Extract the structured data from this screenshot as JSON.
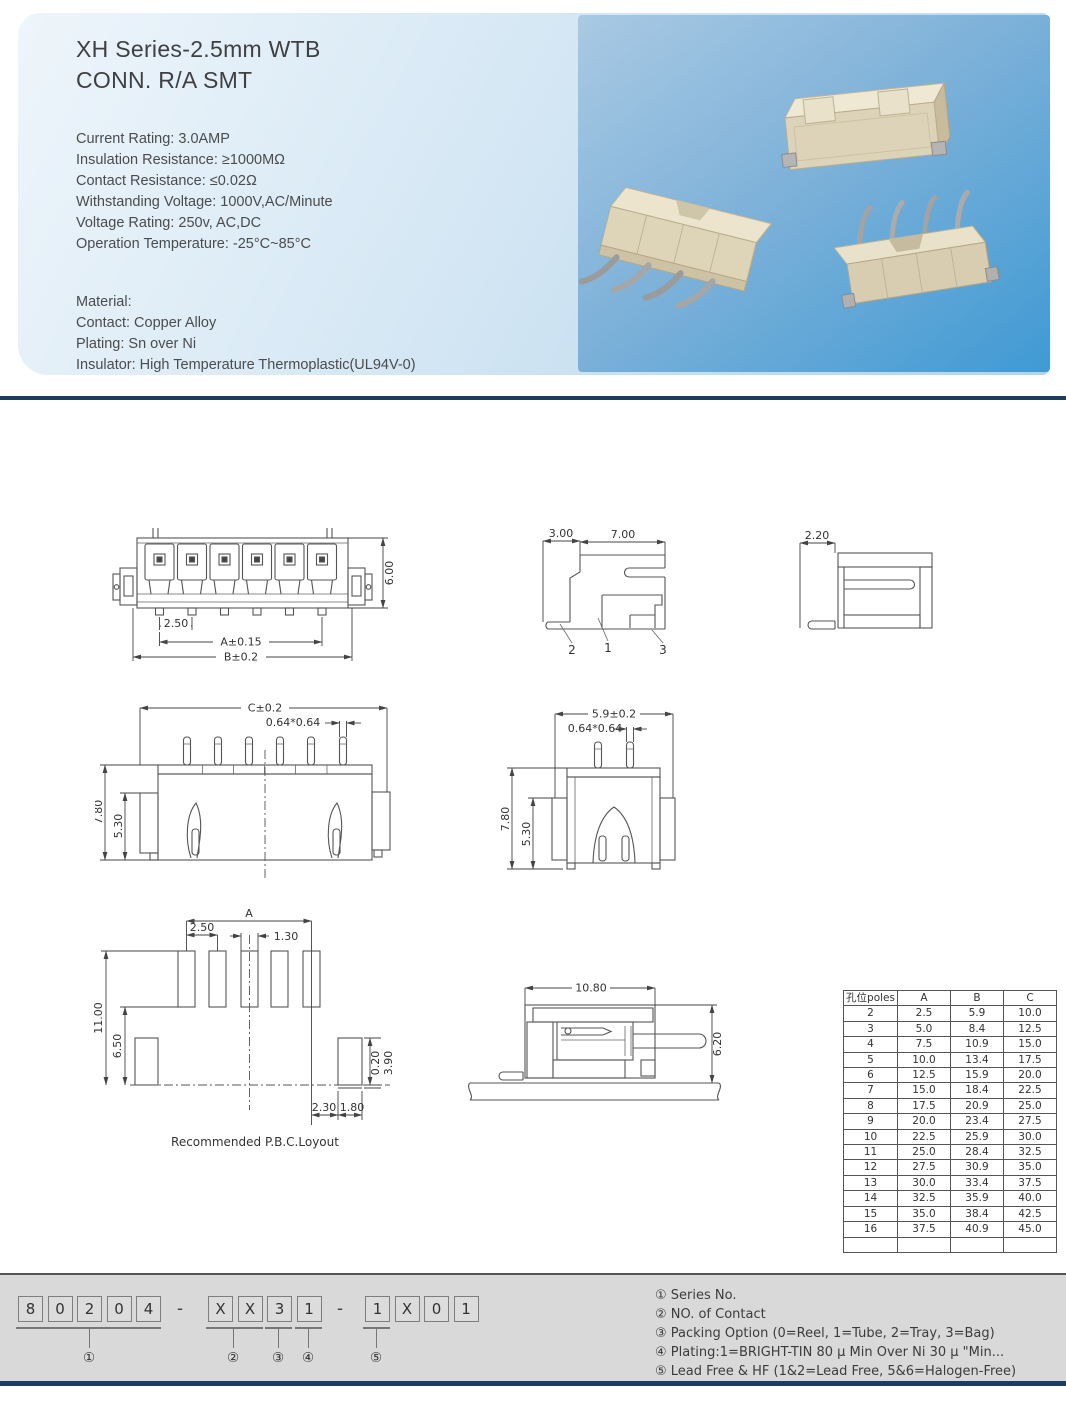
{
  "header": {
    "title_line1": "XH Series-2.5mm WTB",
    "title_line2": "CONN. R/A SMT",
    "specs": [
      "Current Rating: 3.0AMP",
      "Insulation Resistance: ≥1000MΩ",
      "Contact Resistance: ≤0.02Ω",
      "Withstanding Voltage: 1000V,AC/Minute",
      "Voltage Rating: 250v, AC,DC",
      "Operation Temperature: -25°C~85°C"
    ],
    "material": [
      "Material:",
      "Contact: Copper Alloy",
      "Plating: Sn over Ni",
      "Insulator: High Temperature Thermoplastic(UL94V-0)"
    ]
  },
  "drawings": {
    "front_view": {
      "pitch": "2.50",
      "dim_a": "A±0.15",
      "dim_b": "B±0.2",
      "height": "6.00"
    },
    "side_view": {
      "depth": "3.00",
      "width": "7.00",
      "callout_1": "1",
      "callout_2": "2",
      "callout_3": "3"
    },
    "section_view": {
      "width": "2.20"
    },
    "back_view": {
      "dim_c": "C±0.2",
      "pin": "0.64*0.64",
      "height": "7.80",
      "inner_height": "5.30"
    },
    "end_view": {
      "width": "5.9±0.2",
      "pin": "0.64*0.64",
      "height": "7.80",
      "inner_height": "5.30"
    },
    "pcb_layout": {
      "dim_a": "A",
      "pitch": "2.50",
      "pad_width": "1.30",
      "height": "11.00",
      "inner_height": "6.50",
      "offset": "0.20",
      "pad_height": "3.90",
      "pad_gap": "2.30",
      "pad_w2": "1.80",
      "caption": "Recommended P.B.C.Loyout"
    },
    "mated_view": {
      "width": "10.80",
      "height": "6.20"
    }
  },
  "poles_table": {
    "headers": [
      "孔位poles",
      "A",
      "B",
      "C"
    ],
    "rows": [
      [
        "2",
        "2.5",
        "5.9",
        "10.0"
      ],
      [
        "3",
        "5.0",
        "8.4",
        "12.5"
      ],
      [
        "4",
        "7.5",
        "10.9",
        "15.0"
      ],
      [
        "5",
        "10.0",
        "13.4",
        "17.5"
      ],
      [
        "6",
        "12.5",
        "15.9",
        "20.0"
      ],
      [
        "7",
        "15.0",
        "18.4",
        "22.5"
      ],
      [
        "8",
        "17.5",
        "20.9",
        "25.0"
      ],
      [
        "9",
        "20.0",
        "23.4",
        "27.5"
      ],
      [
        "10",
        "22.5",
        "25.9",
        "30.0"
      ],
      [
        "11",
        "25.0",
        "28.4",
        "32.5"
      ],
      [
        "12",
        "27.5",
        "30.9",
        "35.0"
      ],
      [
        "13",
        "30.0",
        "33.4",
        "37.5"
      ],
      [
        "14",
        "32.5",
        "35.9",
        "40.0"
      ],
      [
        "15",
        "35.0",
        "38.4",
        "42.5"
      ],
      [
        "16",
        "37.5",
        "40.9",
        "45.0"
      ]
    ]
  },
  "part_number": {
    "group1": [
      "8",
      "0",
      "2",
      "0",
      "4"
    ],
    "group2": [
      "X",
      "X",
      "3",
      "1"
    ],
    "group3": [
      "1",
      "X",
      "0",
      "1"
    ],
    "separator": "-",
    "markers": [
      "①",
      "②",
      "③",
      "④",
      "⑤"
    ]
  },
  "legend": {
    "items": [
      "① Series No.",
      "② NO. of Contact",
      "③ Packing Option (0=Reel, 1=Tube, 2=Tray, 3=Bag)",
      "④ Plating:1=BRIGHT-TIN 80 μ Min Over Ni 30 μ \"Min...",
      "⑤ Lead Free & HF (1&2=Lead Free, 5&6=Halogen-Free)"
    ]
  }
}
